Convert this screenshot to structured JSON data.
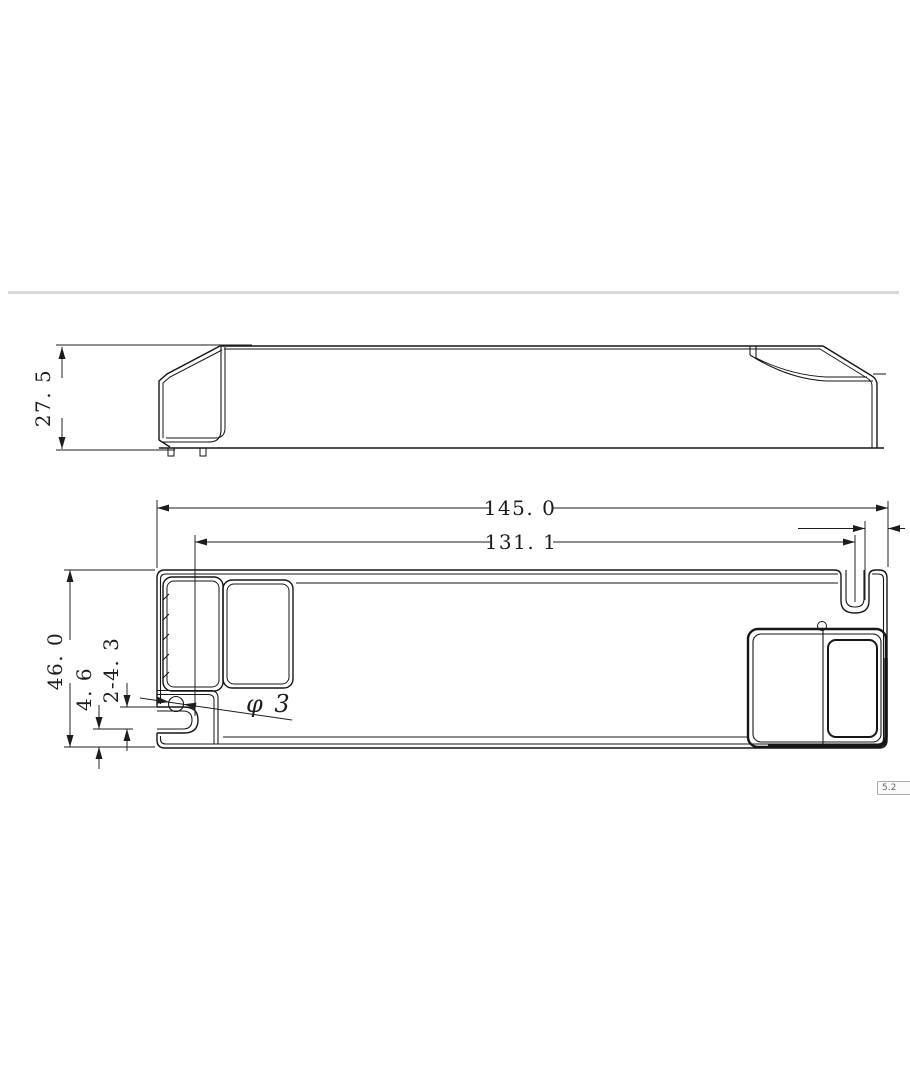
{
  "page": {
    "background": "#ffffff",
    "divider_color": "#d9d9d9",
    "line_color": "#161616"
  },
  "side_view": {
    "height_dim": "27. 5"
  },
  "plan_view": {
    "overall_length_dim": "145. 0",
    "mounting_slot_distance_dim": "131. 1",
    "overall_width_dim": "46. 0",
    "slot_edge_offset_dim": "4. 6",
    "slot_width_dim": "2-4. 3",
    "hole_diameter_dim": "φ 3"
  },
  "badge": {
    "text": "5.2"
  }
}
